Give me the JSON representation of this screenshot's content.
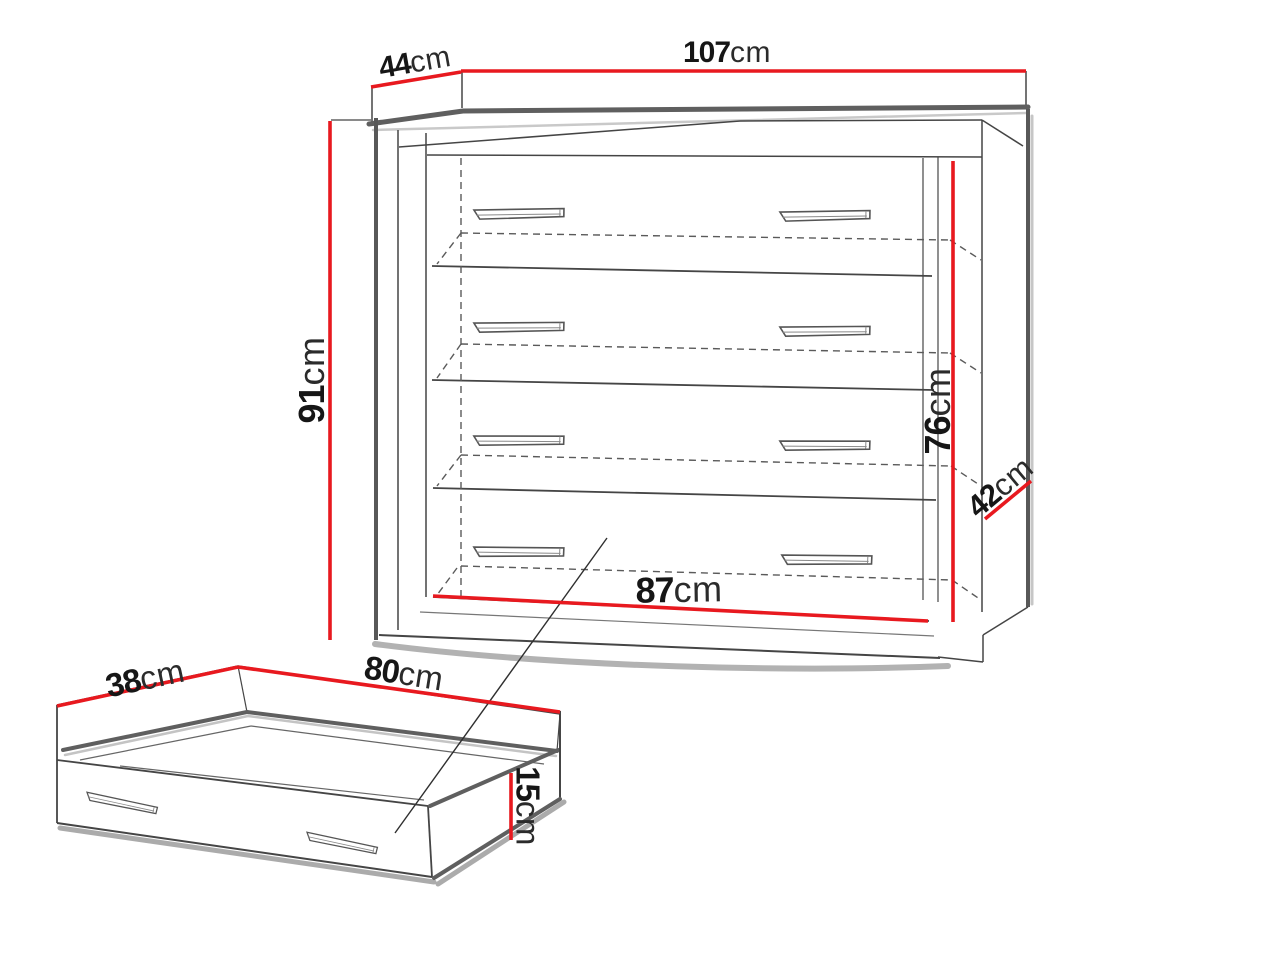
{
  "diagram": {
    "kind": "furniture dimension drawing",
    "subject": "chest of drawers with four drawers and a separate under-bed storage drawer",
    "background": "#ffffff"
  },
  "palette": {
    "dimension_red": "#e8191f",
    "line_dark": "#454545",
    "edge_thick": "#5f5f5f",
    "shadow_gray": "#b2b2b2"
  },
  "cabinet": {
    "name": "chest of drawers",
    "drawer_rows_visible": 4,
    "dimensions": {
      "top_width": {
        "value": "107",
        "unit": "cm"
      },
      "top_depth": {
        "value": "44",
        "unit": "cm"
      },
      "height": {
        "value": "91",
        "unit": "cm"
      },
      "interior_height": {
        "value": "76",
        "unit": "cm"
      },
      "side_depth": {
        "value": "42",
        "unit": "cm"
      },
      "interior_width": {
        "value": "87",
        "unit": "cm"
      }
    }
  },
  "underbed_drawer": {
    "name": "storage drawer",
    "dimensions": {
      "depth": {
        "value": "38",
        "unit": "cm"
      },
      "width": {
        "value": "80",
        "unit": "cm"
      },
      "height": {
        "value": "15",
        "unit": "cm"
      }
    }
  }
}
